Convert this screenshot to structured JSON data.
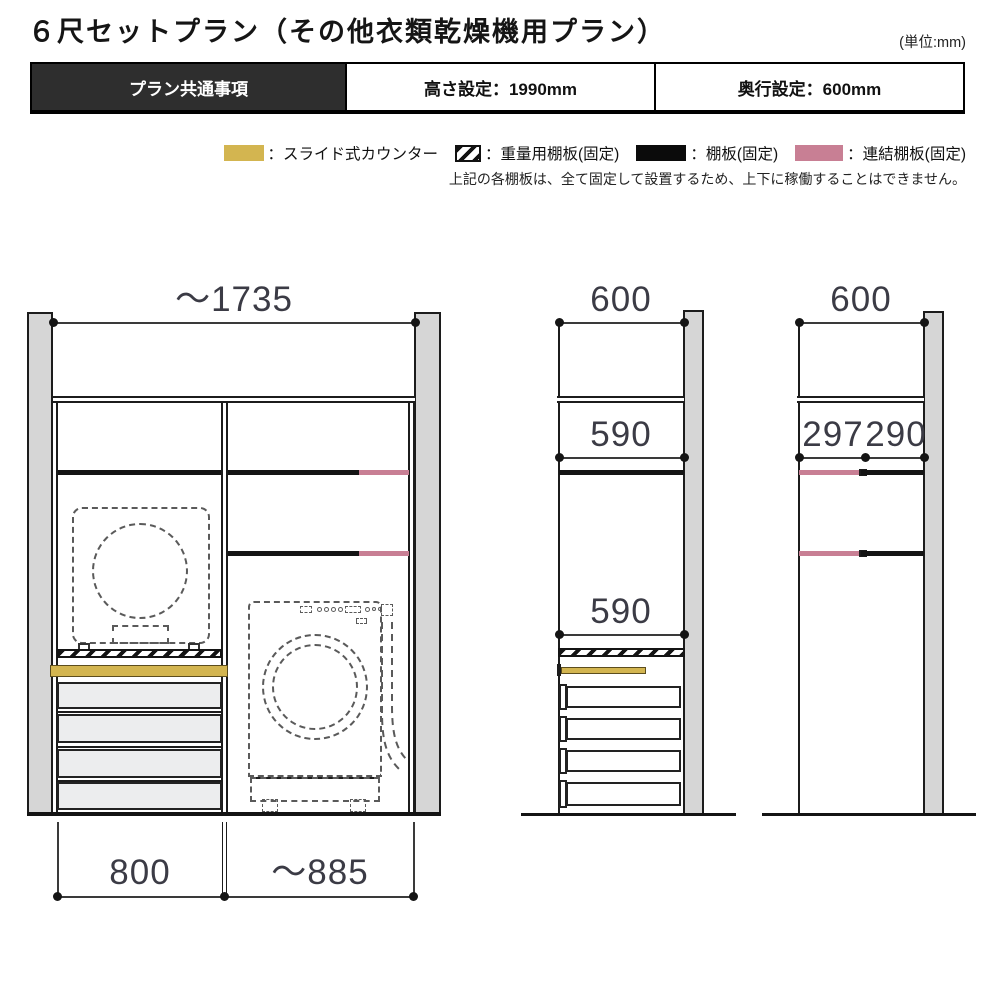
{
  "title": "６尺セットプラン（その他衣類乾燥機用プラン）",
  "unit_note": "(単位:mm)",
  "header": {
    "tab": "プラン共通事項",
    "height_setting": "高さ設定：1990mm",
    "depth_setting": "奥行設定：600mm"
  },
  "legend": {
    "items": [
      {
        "label": "：スライド式カウンター",
        "swatch": "slide-counter",
        "color": "#d3b550"
      },
      {
        "label": "：重量用棚板(固定)",
        "swatch": "heavy-shelf-hatched",
        "color": "#111111"
      },
      {
        "label": "：棚板(固定)",
        "swatch": "shelf-fixed-black",
        "color": "#0b0b0b"
      },
      {
        "label": "：連結棚板(固定)",
        "swatch": "link-shelf-pink",
        "color": "#c87f94"
      }
    ],
    "note": "上記の各棚板は、全て固定して設置するため、上下に稼働することはできません。"
  },
  "drawings": {
    "front_view": {
      "width_top": "～1735",
      "width_left_column": "800",
      "width_right_column": "～885"
    },
    "side_view_a": {
      "depth_top": "600",
      "dim_upper": "590",
      "dim_lower": "590"
    },
    "side_view_b": {
      "depth_top": "600",
      "dim_left": "297",
      "dim_right": "290"
    }
  },
  "colors": {
    "accent_yellow": "#d3b550",
    "accent_pink": "#c87f94",
    "panel_gray": "#d6d6d6",
    "header_dark": "#2e2e2e"
  }
}
